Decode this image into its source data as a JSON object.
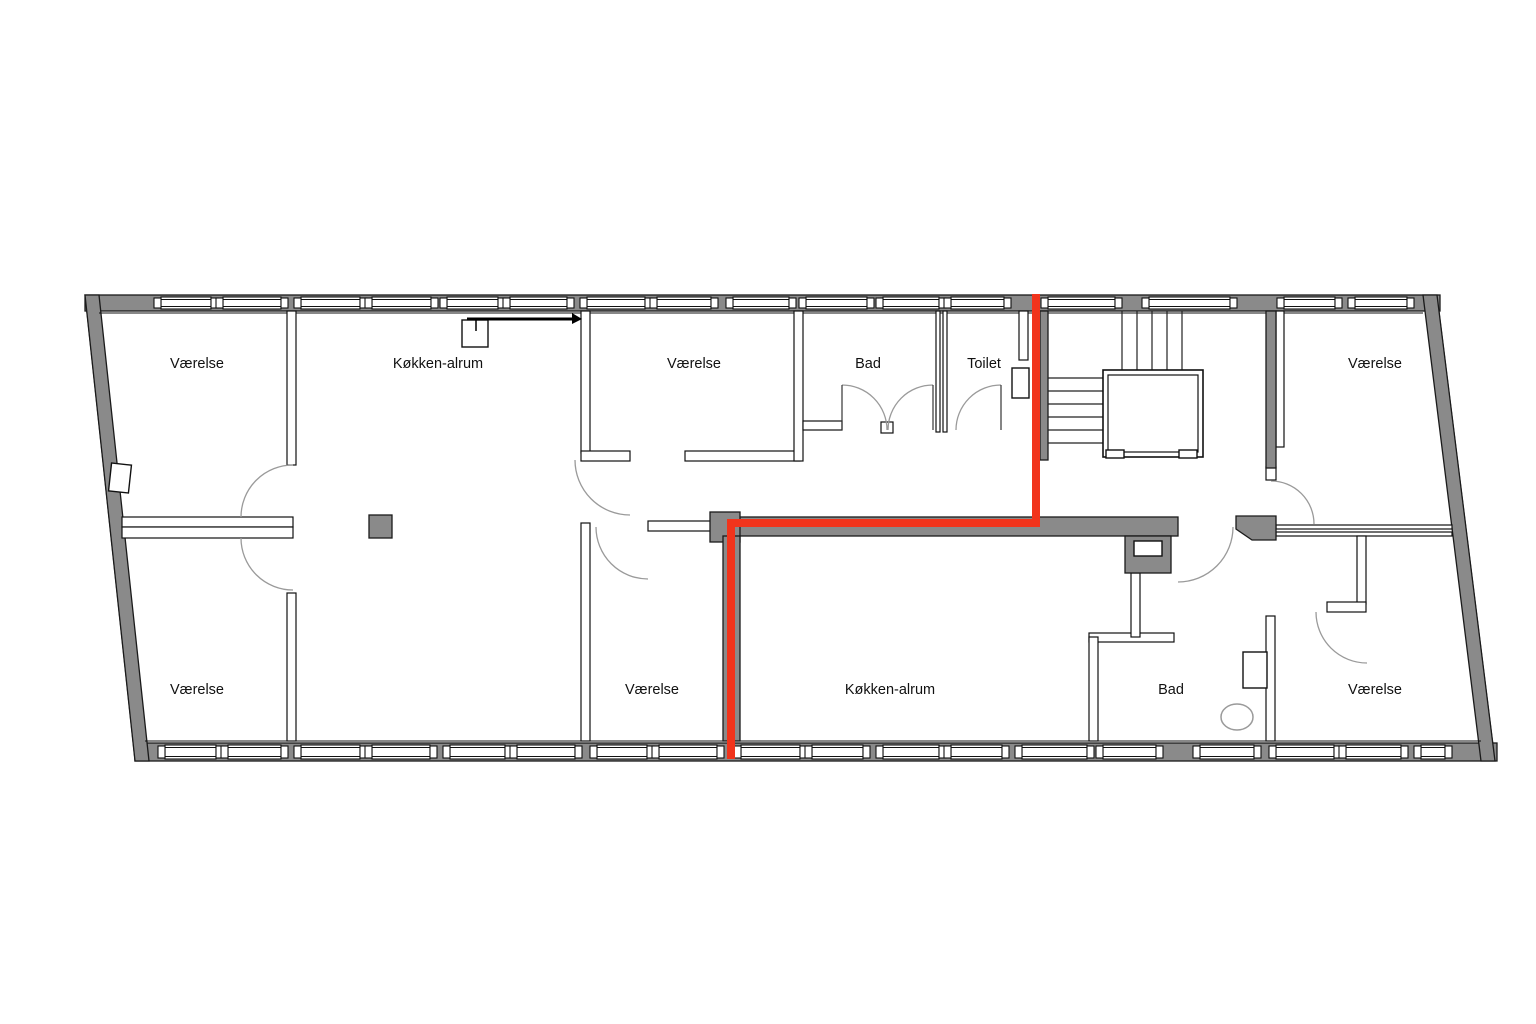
{
  "plan": {
    "highlight_color": "#f1341c",
    "wall_fill": "#8a8a8a",
    "line_color": "#1a1a1a",
    "rooms": [
      {
        "id": "vaerelse-top-left",
        "label": "Værelse"
      },
      {
        "id": "koekken-alrum-top",
        "label": "Køkken-alrum"
      },
      {
        "id": "vaerelse-top-center",
        "label": "Værelse"
      },
      {
        "id": "bad-top",
        "label": "Bad"
      },
      {
        "id": "toilet",
        "label": "Toilet"
      },
      {
        "id": "vaerelse-top-right",
        "label": "Værelse"
      },
      {
        "id": "vaerelse-bottom-left",
        "label": "Værelse"
      },
      {
        "id": "vaerelse-bottom-center",
        "label": "Værelse"
      },
      {
        "id": "koekken-alrum-bottom",
        "label": "Køkken-alrum"
      },
      {
        "id": "bad-bottom",
        "label": "Bad"
      },
      {
        "id": "vaerelse-bottom-right",
        "label": "Værelse"
      }
    ]
  }
}
